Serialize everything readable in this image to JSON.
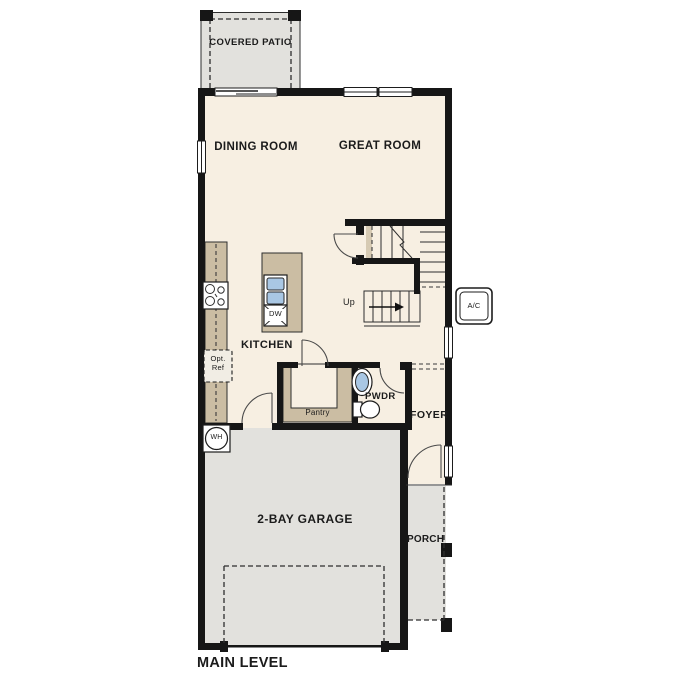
{
  "plan": {
    "level_label": "MAIN LEVEL",
    "rooms": {
      "covered_patio": "COVERED PATIO",
      "dining_room": "DINING ROOM",
      "great_room": "GREAT ROOM",
      "kitchen": "KITCHEN",
      "pantry": "Pantry",
      "powder_room": "PWDR",
      "foyer": "FOYER",
      "garage": "2-BAY GARAGE",
      "porch": "PORCH"
    },
    "fixtures": {
      "dishwasher": "DW",
      "water_heater": "WH",
      "ac_unit": "A/C",
      "optional_refrigerator": "Opt. Ref",
      "stairs_direction": "Up"
    },
    "colors": {
      "floor": "#f7efe2",
      "outdoor": "#e2e1dd",
      "cabinetry": "#cbbda3",
      "wall": "#161616",
      "sink": "#a9c7e4"
    }
  }
}
